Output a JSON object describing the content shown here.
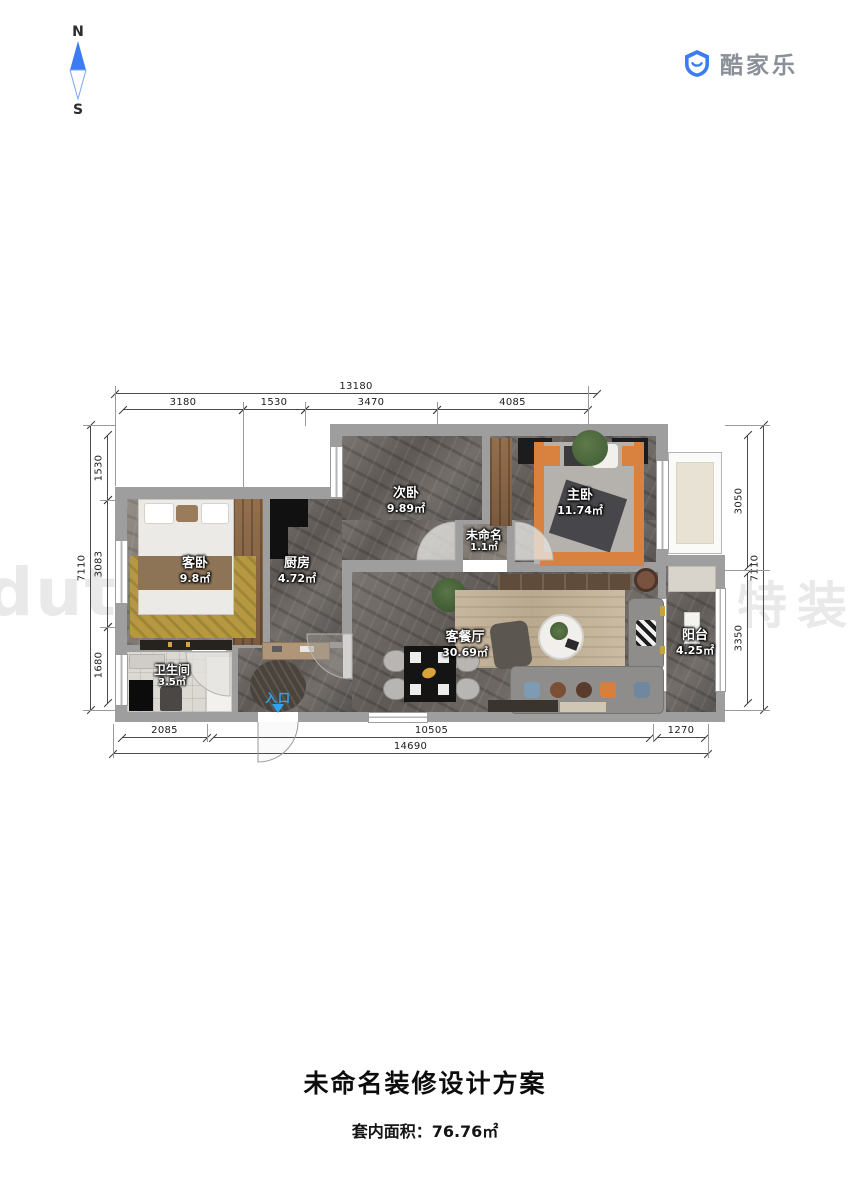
{
  "compass": {
    "north": "N",
    "south": "S"
  },
  "logo": {
    "brand": "酷家乐"
  },
  "watermarks": {
    "left": "dute",
    "right": "特装饰"
  },
  "rooms": [
    {
      "name": "次卧",
      "area": "9.89㎡"
    },
    {
      "name": "主卧",
      "area": "11.74㎡"
    },
    {
      "name": "未命名",
      "area": "1.1㎡"
    },
    {
      "name": "客卧",
      "area": "9.8㎡"
    },
    {
      "name": "厨房",
      "area": "4.72㎡"
    },
    {
      "name": "卫生间",
      "area": "3.5㎡"
    },
    {
      "name": "客餐厅",
      "area": "30.69㎡"
    },
    {
      "name": "阳台",
      "area": "4.25㎡"
    }
  ],
  "entrance_label": "入口",
  "dimensions": {
    "top_total": "13180",
    "top_segments": [
      "3180",
      "1530",
      "3470",
      "4085"
    ],
    "left_total": "7110",
    "left_segments": [
      "1530",
      "3083",
      "1680"
    ],
    "right_total": "7110",
    "right_segments": [
      "3050",
      "3350"
    ],
    "bottom_segments": [
      "2085",
      "10505",
      "1270"
    ],
    "bottom_total": "14690"
  },
  "footer": {
    "title": "未命名装修设计方案",
    "area_text": "套内面积：76.76㎡"
  },
  "colors": {
    "accent_blue": "#3b7cf5",
    "entrance_blue": "#2da5f2",
    "wall_gray": "#9e9e9e",
    "marble_dark": "#6e6965",
    "bed_orange": "#d9823f",
    "rug_yellow": "#b5983f",
    "logo_gray": "#8a9099",
    "watermark_gray": "#e9e9e9",
    "title_black": "#0d0d0d"
  }
}
